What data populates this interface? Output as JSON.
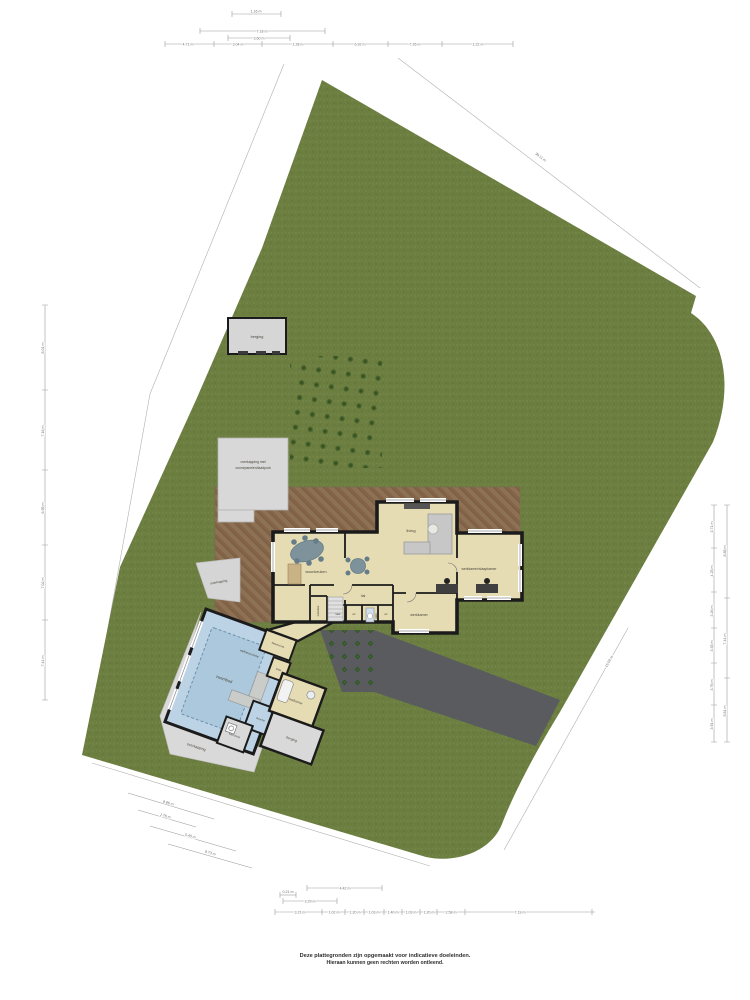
{
  "footer": {
    "line1": "Deze plattegronden zijn opgemaakt voor indicatieve doeleinden.",
    "line2": "Hieraan kunnen geen rechten worden ontleend."
  },
  "site": {
    "shed": "berging",
    "carport_line1": "overkapping met",
    "carport_line2": "zonnepanelen/laadpunt",
    "walkway": "overkapping",
    "apron": "overkapping"
  },
  "house": {
    "woonkeuken": "woonkeuken",
    "living": "living",
    "office_bedroom": "werkkamer/slaapkamer",
    "hal": "hal",
    "werkkamer": "werkkamer",
    "meterkast": "meterkast",
    "kast": "kast",
    "wc_left": "wc",
    "toilet": "toilet",
    "wc_right": "wc"
  },
  "poolhouse": {
    "zwembad": "zwembad",
    "wellness": "wellnessruimte",
    "kleedruimte": "kleedruimte",
    "toilet": "toilet",
    "douche": "douche",
    "badkamer": "badkamer",
    "berging": "berging",
    "wasruimte": "wasruimte"
  },
  "dimensions": {
    "top_mini": "1.16 m",
    "top_bracket_a": "7.18 m",
    "top_bracket_b": "3.60 m",
    "top_chain": [
      "4.71 m",
      "3.04 m",
      "1.28 m",
      "6.92 m",
      "7.26 m",
      "1.22 m"
    ],
    "left_chain": [
      "8.01 m",
      "7.16 m",
      "6.95 m",
      "7.02 m",
      "7.44 m"
    ],
    "right_inner": [
      "3.71 m",
      "4.25 m",
      "3.26 m",
      "3.35 m",
      "3.76 m",
      "3.91 m"
    ],
    "right_outer": [
      "8.85 m",
      "7.44 m",
      "5.81 m"
    ],
    "bottom_bracket": "4.42 m",
    "bottom_small": "0.21 m",
    "bottom_mid": "3.29 m",
    "bottom_chain": [
      "3.21 m",
      "1.02 m",
      "1.20 m",
      "1.03 m",
      "1.40 m",
      "1.03 m",
      "1.20 m",
      "2.58 m",
      "7.19 m"
    ],
    "diag_left": [
      "8.86 m",
      "1.76 m",
      "5.40 m",
      "8.73 m"
    ],
    "diag_top_right": "38.11 m",
    "diag_bottom_right": "15.09 m"
  },
  "colors": {
    "grass": "#6d7e41",
    "terrace": "#8d7153",
    "driveway": "#595b5e",
    "pool_hall": "#bcd3e6",
    "pool_water": "#abc8dd",
    "floor": "#e6dcb4",
    "wall": "#1b1b1b",
    "grey_structure": "#d6d6d6"
  }
}
